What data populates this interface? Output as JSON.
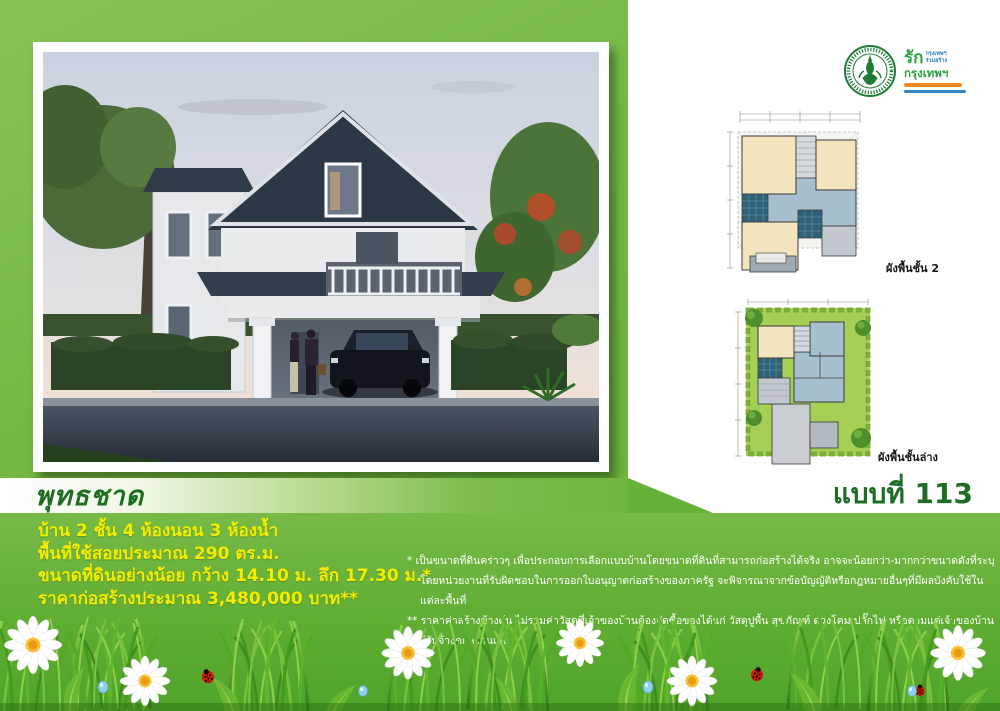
{
  "page": {
    "house_name": "พุทธชาด",
    "design_no": "แบบที่ 113"
  },
  "specs": {
    "storeys_bedrooms_baths": "บ้าน 2 ชั้น 4 ห้องนอน 3 ห้องน้ำ",
    "usable_area": "พื้นที่ใช้สอยประมาณ 290 ตร.ม.",
    "land_size": "ขนาดที่ดินอย่างน้อย กว้าง 14.10 ม. ลึก 17.30 ม.*",
    "construction_price": "ราคาก่อสร้างประมาณ 3,480,000 บาท**"
  },
  "footnotes": {
    "note1_line1": "* เป็นขนาดที่ดินคร่าวๆ  เพื่อประกอบการเลือกแบบบ้านโดยขนาดที่ดินที่สามารถก่อสร้างได้จริง  อาจจะน้อยกว่า-มากกว่าขนาดดังที่ระบุ",
    "note1_line2": "โดยหน่วยงานที่รับผิดชอบในการออกใบอนุญาตก่อสร้างของภาครัฐ  จะพิจารณาจากข้อบัญญัติหรือกฎหมายอื่นๆที่มีผลบังคับใช้ในแต่ละพื้นที่",
    "note2": "** ราคาค่าสร้างข้างต้น ไม่รวมค่าวัสดุที่เจ้าของบ้านต้องจัดซื้อของได้แก่ วัสดุปูพื้น สุขภัณฑ์ ดวงโคม ปลั๊กไฟ หรือตามแต่เจ้าของบ้านกับผู้รับจ้างตกลงกันเอง"
  },
  "floor_plans": {
    "upper_caption": "ผังพื้นชั้น 2",
    "lower_caption": "ผังพื้นชั้นล่าง"
  },
  "logo": {
    "love": "รัก",
    "small_top": "กรุงเทพฯ",
    "small_bottom": "ร่วมสร้าง",
    "bangkok": "กรุงเทพฯ"
  },
  "colors": {
    "panel_green": "#74b843",
    "section_green": "#60ad33",
    "title_green": "#1a6e1e",
    "spec_yellow": "#f5ec00",
    "logo_green": "#1e7c35"
  }
}
